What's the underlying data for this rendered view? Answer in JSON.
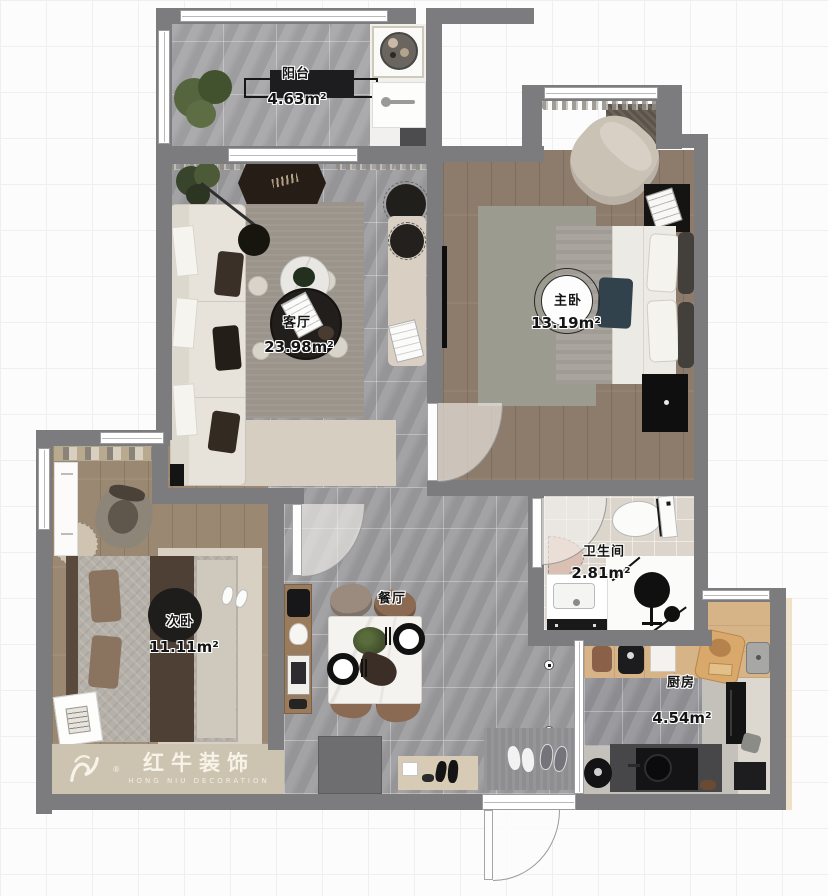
{
  "watermark": {
    "brand": "红牛装饰",
    "subtitle": "HONG NIU DECORATION",
    "registered": "®"
  },
  "rooms": [
    {
      "id": "balcony",
      "name": "阳台",
      "area": "4.63m²"
    },
    {
      "id": "living",
      "name": "客厅",
      "area": "23.98m²"
    },
    {
      "id": "master",
      "name": "主卧",
      "area": "13.19m²"
    },
    {
      "id": "second",
      "name": "次卧",
      "area": "11.11m²"
    },
    {
      "id": "dining",
      "name": "餐厅",
      "area": ""
    },
    {
      "id": "bathroom",
      "name": "卫生间",
      "area": "2.81m²"
    },
    {
      "id": "kitchen",
      "name": "厨房",
      "area": "4.54m²"
    }
  ],
  "colors": {
    "wall": "#7c7c7e",
    "tile_floor": "#9e9ea1",
    "wood_floor": "#8d7b6b",
    "wood_floor_light": "#9a8873",
    "counter_wood": "#d6b488",
    "accent_dark": "#1d1d1f",
    "mat_tan": "#cdc3b1"
  }
}
